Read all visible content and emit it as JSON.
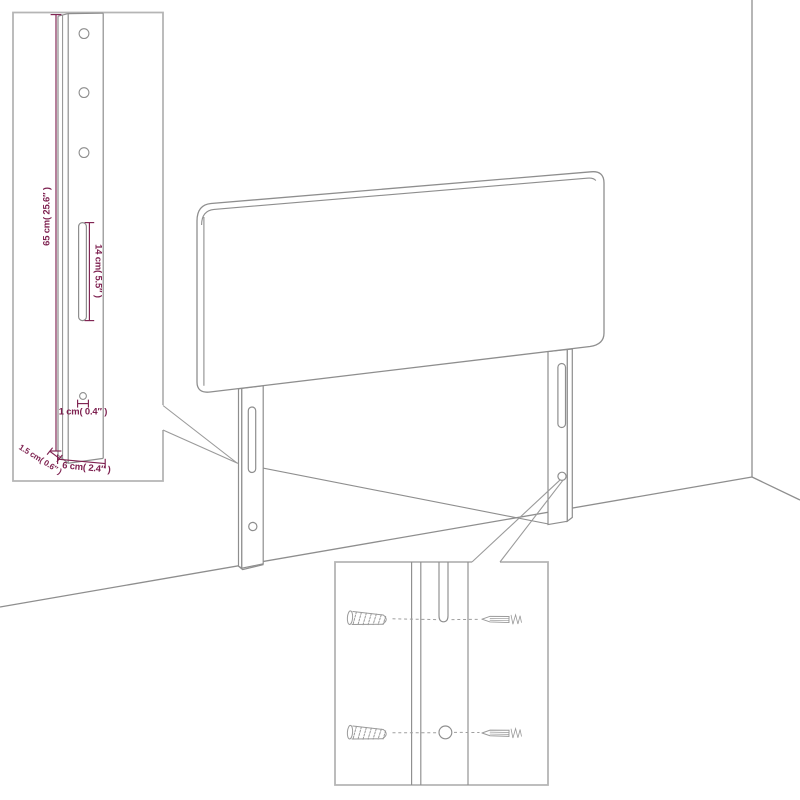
{
  "diagram": {
    "subject": "headboard-with-adjustable-legs",
    "view": "room-corner-perspective-line-drawing"
  },
  "colors": {
    "background": "#ffffff",
    "drawing_line": "#8e8e8e",
    "callout_line": "#9a9a9a",
    "inset_border": "#b5b5b5",
    "dimension": "#7e2150"
  },
  "dim_labels": {
    "leg_height": "65 cm( 25.6″ )",
    "slot_length": "14 cm( 5.5″ )",
    "hole_width": "1 cm( 0.4″ )",
    "leg_width": "6 cm( 2.4″ )",
    "leg_thickness": "1.5 cm( 0.6″ )"
  },
  "icons": {
    "wall_plug": "hatched-wall-plug",
    "screw": "side-view-screw",
    "slot": "vertical-slot",
    "hole": "round-hole"
  }
}
